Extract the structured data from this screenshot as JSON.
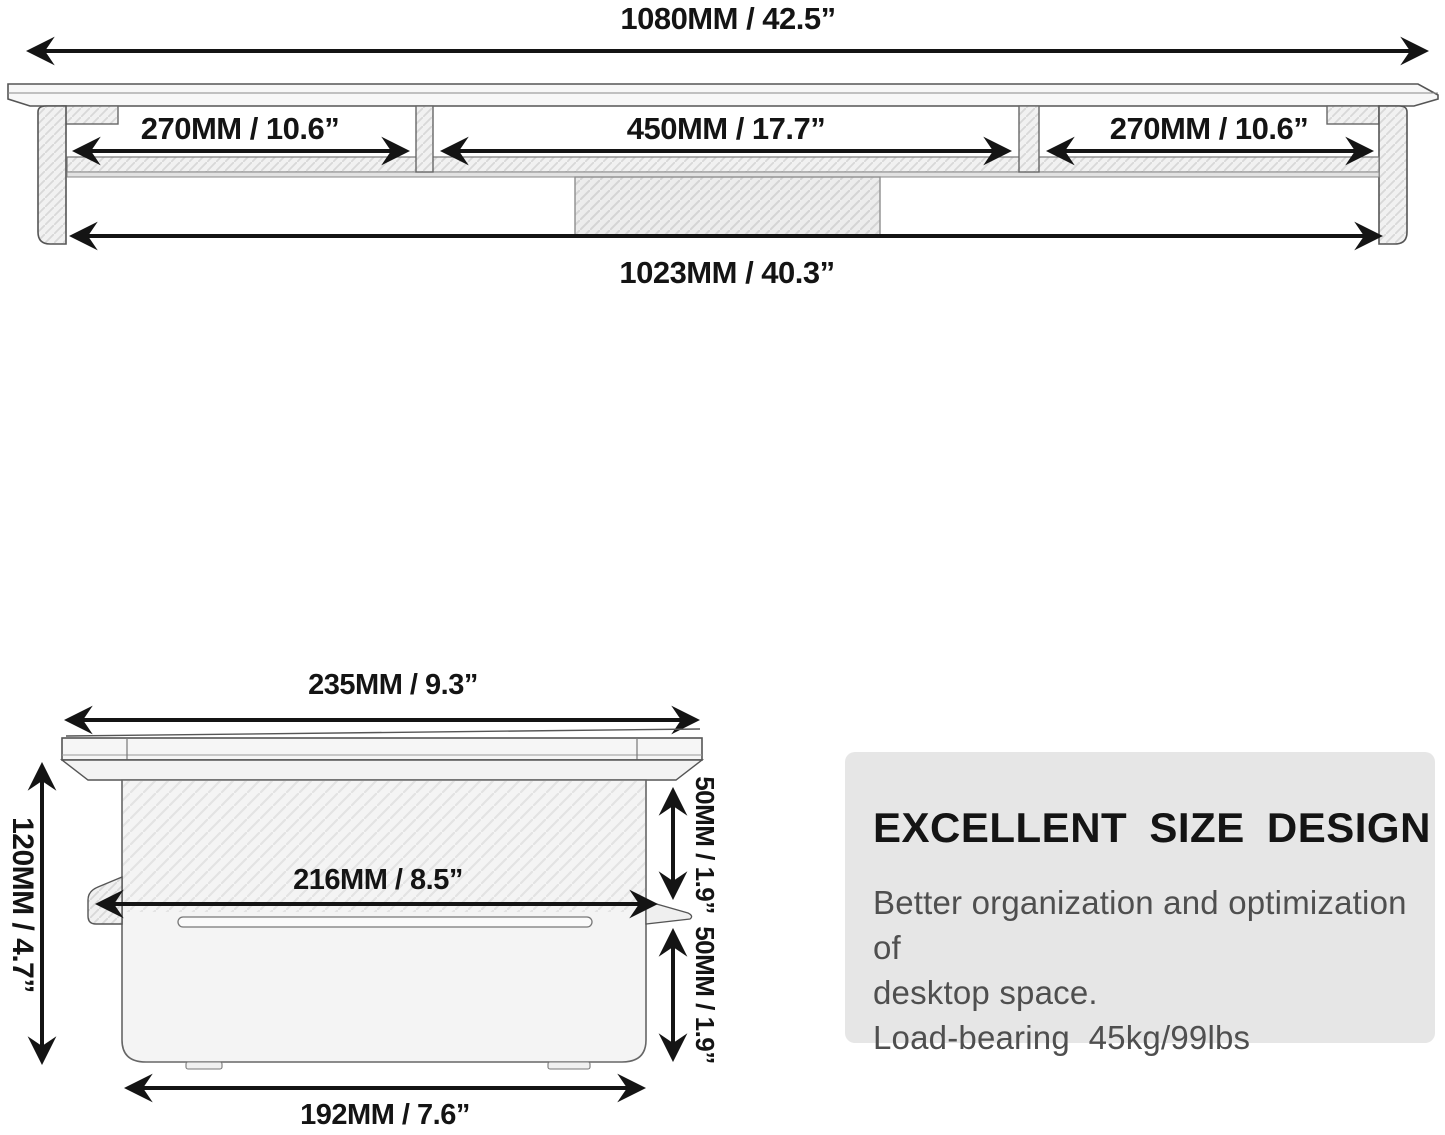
{
  "top_view": {
    "total_width_label": "1080MM / 42.5”",
    "left_section_label": "270MM / 10.6”",
    "middle_section_label": "450MM / 17.7”",
    "right_section_label": "270MM / 10.6”",
    "inner_width_label": "1023MM / 40.3”"
  },
  "side_view": {
    "top_width_label": "235MM / 9.3”",
    "height_label": "120MM / 4.7”",
    "inner_width_label": "216MM / 8.5”",
    "upper_clearance_label": "50MM / 1.9”",
    "lower_clearance_label": "50MM / 1.9”",
    "base_width_label": "192MM / 7.6”"
  },
  "info_box": {
    "heading": "EXCELLENT SIZE DESIGN",
    "line1": "Better organization and optimization of",
    "line2": "desktop space.",
    "line3": "Load-bearing  45kg/99lbs",
    "background": "#e6e6e6",
    "heading_color": "#141414",
    "body_color": "#4f4f4f"
  },
  "style": {
    "dimension_color": "#141414",
    "line_art_color": "#555555",
    "page_background": "#ffffff"
  }
}
